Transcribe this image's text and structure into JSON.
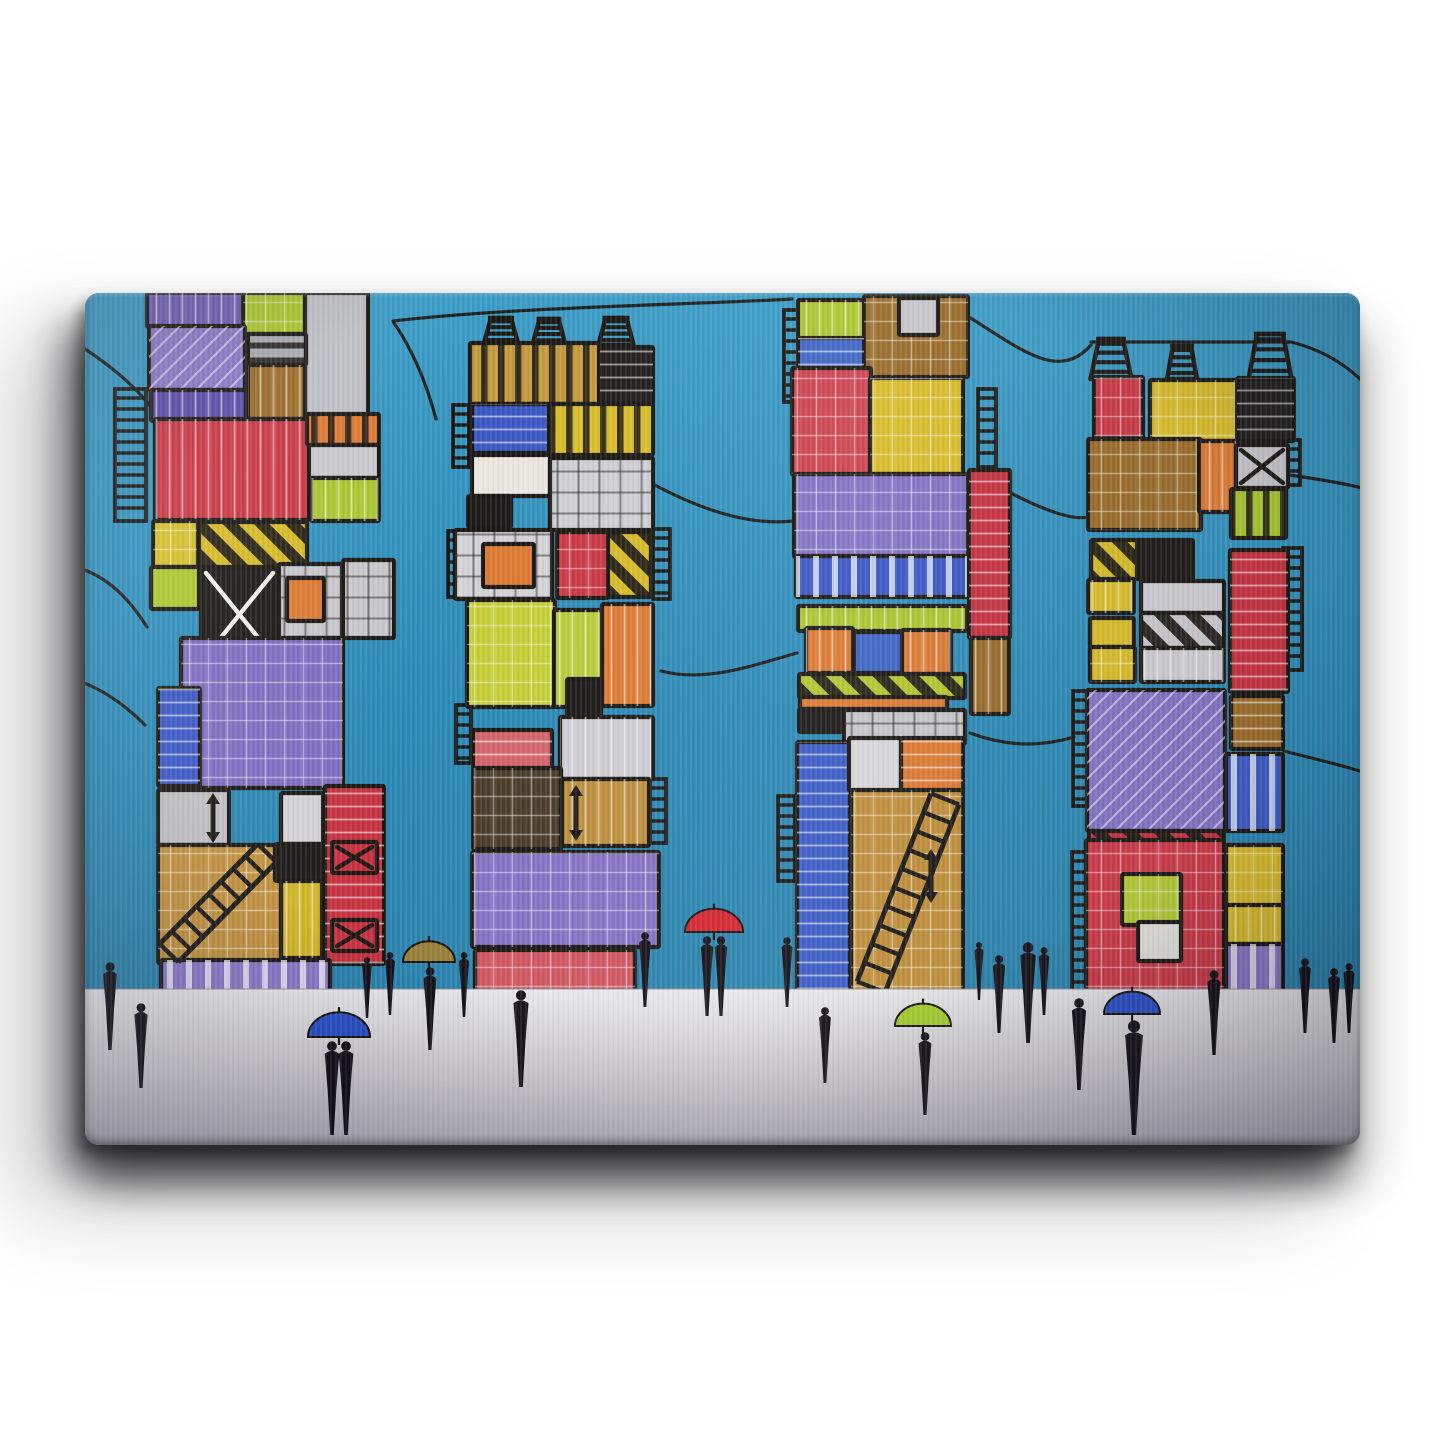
{
  "artwork": {
    "viewbox": "0 0 1275 852",
    "colors": {
      "sky": "#2b89b6",
      "sky_top": "#3b9cc6",
      "sky_bottom": "#2a7fa8",
      "ground_top": "#e8e7ea",
      "ground_mid": "#d2d0d5",
      "ground_bottom": "#b9b7be",
      "line": "#1b1814",
      "figure": "#15121a"
    },
    "ground_y": 696,
    "power_lines": [
      "M -6,52 C 55,92 88,128 102,196",
      "M -6,275 C 28,286 48,312 62,334",
      "M -6,388 C 22,398 44,416 60,432",
      "M 308,28 C 430,14 600,12 707,6",
      "M 309,30 C 331,62 343,96 351,126",
      "M 566,190 C 625,222 672,232 708,228",
      "M 576,378 C 622,390 668,372 712,360",
      "M 884,24 C 938,58 974,88 1006,52",
      "M 1006,49 L 1206,49",
      "M 1206,49 C 1242,58 1266,76 1281,92",
      "M 887,178 C 948,215 986,228 1003,224",
      "M 1204,182 C 1240,187 1266,192 1281,196",
      "M 885,440 C 928,456 962,452 989,444",
      "M 1199,458 C 1238,468 1264,474 1281,480"
    ],
    "towers": [
      {
        "name": "tower-1",
        "containers": [
          [
            62,
            0,
            96,
            34,
            "#6e5eb4",
            "vw"
          ],
          [
            158,
            0,
            62,
            41,
            "#aac72f",
            "gw"
          ],
          [
            220,
            0,
            63,
            126,
            "#bfc0c5",
            ""
          ],
          [
            64,
            33,
            96,
            64,
            "#8a7ac8",
            "dg"
          ],
          [
            66,
            97,
            95,
            31,
            "#5a4aa8",
            "vw"
          ],
          [
            163,
            41,
            58,
            31,
            "#a9aab0",
            "bh"
          ],
          [
            163,
            72,
            57,
            54,
            "#9a6b28",
            "vw"
          ],
          [
            70,
            126,
            154,
            101,
            "#c93744",
            "vw"
          ],
          [
            222,
            121,
            72,
            31,
            "#dd7a32",
            "bv"
          ],
          [
            224,
            152,
            70,
            33,
            "#c9c9ce",
            ""
          ],
          [
            226,
            185,
            68,
            43,
            "#aac72f",
            "vw"
          ],
          [
            68,
            228,
            45,
            46,
            "#d3c02b",
            "gw"
          ],
          [
            114,
            229,
            108,
            45,
            "#d6bb28",
            "hz"
          ],
          [
            66,
            274,
            48,
            42,
            "#aac72f",
            ""
          ],
          [
            116,
            275,
            77,
            93,
            "#1d1b1a",
            "xw"
          ],
          [
            194,
            271,
            63,
            74,
            "#c7c7cc",
            "gd"
          ],
          [
            202,
            285,
            37,
            43,
            "#dd7a32",
            ""
          ],
          [
            258,
            267,
            51,
            78,
            "#c7c7cc",
            "gd"
          ],
          [
            96,
            345,
            162,
            150,
            "#7e6cc0",
            "gw"
          ],
          [
            73,
            395,
            42,
            98,
            "#3a57c4",
            "hw"
          ],
          [
            73,
            497,
            71,
            55,
            "#bebec3",
            ""
          ],
          [
            73,
            552,
            171,
            118,
            "#c1903e",
            "gw"
          ],
          [
            196,
            500,
            42,
            51,
            "#d2d2d6",
            ""
          ],
          [
            190,
            551,
            48,
            37,
            "#1d1b1a",
            ""
          ],
          [
            196,
            588,
            41,
            77,
            "#d1b524",
            "vw"
          ],
          [
            240,
            493,
            59,
            178,
            "#c63140",
            "hw"
          ],
          [
            247,
            549,
            45,
            31,
            "#c63140",
            "xb"
          ],
          [
            247,
            627,
            45,
            31,
            "#c63140",
            "xb"
          ],
          [
            76,
            667,
            169,
            45,
            "#8a79c8",
            "wb"
          ]
        ],
        "racks": [
          [
            30,
            96,
            31,
            132
          ]
        ],
        "funnels": [],
        "stairs": [
          {
            "x1": 84,
            "y1": 660,
            "x2": 182,
            "y2": 560,
            "w": 26,
            "steps": 8
          }
        ],
        "arrows": [
          [
            128,
            500,
            550
          ]
        ]
      },
      {
        "name": "tower-2",
        "containers": [
          [
            385,
            50,
            129,
            61,
            "#c49a3e",
            "bv"
          ],
          [
            515,
            54,
            53,
            57,
            "#211f1e",
            "hw"
          ],
          [
            387,
            111,
            77,
            49,
            "#3a57c4",
            "hw"
          ],
          [
            464,
            111,
            104,
            51,
            "#d9bd2a",
            "bv"
          ],
          [
            387,
            162,
            78,
            41,
            "#e9e7e0",
            ""
          ],
          [
            383,
            203,
            43,
            31,
            "#1d1b1a",
            ""
          ],
          [
            465,
            165,
            103,
            72,
            "#cfcfd4",
            "gd"
          ],
          [
            370,
            237,
            97,
            69,
            "#d4d4d8",
            "gd"
          ],
          [
            398,
            251,
            51,
            43,
            "#dd7a32",
            ""
          ],
          [
            472,
            239,
            51,
            66,
            "#c93744",
            "gw"
          ],
          [
            523,
            239,
            43,
            65,
            "#d6bb28",
            "hz"
          ],
          [
            382,
            307,
            88,
            107,
            "#c6ce35",
            "gw"
          ],
          [
            469,
            317,
            48,
            97,
            "#b9cc3a",
            "vw"
          ],
          [
            517,
            311,
            51,
            102,
            "#dd7a32",
            "vw"
          ],
          [
            482,
            386,
            34,
            40,
            "#1d1b1a",
            ""
          ],
          [
            388,
            437,
            79,
            39,
            "#d4636b",
            "hw"
          ],
          [
            475,
            424,
            93,
            62,
            "#cdcdd2",
            "vw"
          ],
          [
            388,
            475,
            88,
            81,
            "#4a3b28",
            "gw"
          ],
          [
            477,
            486,
            87,
            67,
            "#bd8e3c",
            "vw"
          ],
          [
            387,
            559,
            187,
            95,
            "#8272c4",
            "gw"
          ],
          [
            390,
            657,
            160,
            41,
            "#cf5560",
            "gw"
          ]
        ],
        "racks": [
          [
            368,
            112,
            16,
            62
          ],
          [
            363,
            238,
            16,
            66
          ],
          [
            568,
            236,
            17,
            70
          ],
          [
            371,
            412,
            15,
            58
          ],
          [
            565,
            486,
            16,
            64
          ]
        ],
        "funnels": [
          [
            416,
            52,
            35,
            20,
            27
          ],
          [
            464,
            52,
            33,
            19,
            26
          ],
          [
            531,
            52,
            35,
            21,
            27
          ]
        ],
        "stairs": [],
        "arrows": [
          [
            491,
            492,
            548
          ]
        ]
      },
      {
        "name": "tower-3",
        "containers": [
          [
            713,
            7,
            67,
            39,
            "#aac72f",
            "vw"
          ],
          [
            779,
            3,
            104,
            81,
            "#9a6b28",
            "gw"
          ],
          [
            814,
            5,
            39,
            37,
            "#c7c7cc",
            ""
          ],
          [
            713,
            45,
            66,
            31,
            "#3f66c6",
            "hw"
          ],
          [
            707,
            75,
            79,
            107,
            "#cc4450",
            "gw"
          ],
          [
            785,
            85,
            93,
            96,
            "#d9bd2a",
            "gw"
          ],
          [
            709,
            181,
            174,
            83,
            "#8272c4",
            "gw"
          ],
          [
            711,
            263,
            173,
            41,
            "#3a57c4",
            "wb"
          ],
          [
            713,
            313,
            169,
            25,
            "#aac72f",
            "vw"
          ],
          [
            721,
            335,
            47,
            45,
            "#dd7a32",
            "vw"
          ],
          [
            769,
            339,
            49,
            41,
            "#3f66c6",
            ""
          ],
          [
            817,
            337,
            49,
            44,
            "#dd7a32",
            "vw"
          ],
          [
            714,
            381,
            166,
            24,
            "#b5c62f",
            "hz"
          ],
          [
            715,
            404,
            147,
            12,
            "#dd7a32",
            ""
          ],
          [
            714,
            416,
            45,
            23,
            "#1d1b1a",
            ""
          ],
          [
            759,
            417,
            121,
            34,
            "#c7c7cc",
            "gd"
          ],
          [
            712,
            449,
            53,
            251,
            "#3a5cc6",
            "hw"
          ],
          [
            764,
            445,
            52,
            53,
            "#d8d8db",
            ""
          ],
          [
            816,
            445,
            62,
            53,
            "#dd7a32",
            "hw"
          ],
          [
            766,
            497,
            112,
            203,
            "#bf8e3a",
            "gw"
          ],
          [
            884,
            177,
            41,
            168,
            "#c63140",
            "hw"
          ],
          [
            886,
            345,
            38,
            76,
            "#9a6b28",
            "vw"
          ]
        ],
        "racks": [
          [
            699,
            17,
            15,
            92
          ],
          [
            893,
            96,
            18,
            78
          ],
          [
            693,
            503,
            17,
            85
          ]
        ],
        "funnels": [],
        "stairs": [
          {
            "x1": 786,
            "y1": 694,
            "x2": 860,
            "y2": 506,
            "w": 30,
            "steps": 10
          }
        ],
        "arrows": [
          [
            846,
            556,
            610
          ]
        ]
      },
      {
        "name": "tower-4",
        "containers": [
          [
            1009,
            84,
            49,
            61,
            "#c93744",
            "gw"
          ],
          [
            1065,
            87,
            87,
            61,
            "#d9bd2a",
            "gw"
          ],
          [
            1152,
            85,
            57,
            63,
            "#211f1e",
            "hw"
          ],
          [
            1003,
            146,
            113,
            91,
            "#9a6b28",
            "gw"
          ],
          [
            1114,
            148,
            37,
            71,
            "#dd7a32",
            "vw"
          ],
          [
            1151,
            152,
            52,
            43,
            "#c7c7cc",
            "xb"
          ],
          [
            1146,
            196,
            55,
            49,
            "#aac72f",
            "bv"
          ],
          [
            1006,
            247,
            47,
            39,
            "#d6bb28",
            "hz"
          ],
          [
            1052,
            247,
            56,
            39,
            "#1d1b1a",
            ""
          ],
          [
            1145,
            257,
            58,
            142,
            "#c63140",
            "hw"
          ],
          [
            1003,
            287,
            46,
            33,
            "#d9bd2a",
            "vw"
          ],
          [
            1056,
            288,
            83,
            32,
            "#cdcdd2",
            ""
          ],
          [
            1056,
            320,
            83,
            35,
            "#c9c9cd",
            "hz"
          ],
          [
            1005,
            325,
            44,
            29,
            "#d9bd2a",
            ""
          ],
          [
            1005,
            354,
            45,
            35,
            "#d9bd2a",
            "gw"
          ],
          [
            1056,
            355,
            83,
            34,
            "#cdcdd2",
            "vw"
          ],
          [
            1002,
            397,
            138,
            141,
            "#8272c4",
            "dg"
          ],
          [
            1146,
            403,
            52,
            53,
            "#9a6b28",
            "hw"
          ],
          [
            1141,
            461,
            57,
            77,
            "#3a5cc6",
            "wb"
          ],
          [
            1004,
            538,
            135,
            11,
            "#c63140",
            "hz"
          ],
          [
            1001,
            547,
            138,
            157,
            "#cc3947",
            "gw"
          ],
          [
            1037,
            581,
            59,
            51,
            "#b5cc35",
            "gw"
          ],
          [
            1053,
            629,
            43,
            39,
            "#e6e4de",
            ""
          ],
          [
            1141,
            552,
            57,
            61,
            "#d9bd2a",
            "gw"
          ],
          [
            1141,
            612,
            57,
            39,
            "#d9bd2a",
            "vw"
          ],
          [
            1141,
            651,
            57,
            53,
            "#8a79c8",
            "wb"
          ]
        ],
        "racks": [
          [
            988,
            398,
            15,
            115
          ],
          [
            987,
            559,
            16,
            140
          ],
          [
            1198,
            147,
            17,
            45
          ],
          [
            1198,
            255,
            19,
            122
          ]
        ],
        "funnels": [
          [
            1026,
            86,
            41,
            24,
            40
          ],
          [
            1097,
            86,
            30,
            18,
            33
          ],
          [
            1185,
            86,
            43,
            26,
            45
          ]
        ],
        "stairs": [],
        "arrows": []
      }
    ],
    "people": [
      [
        25,
        669,
        757,
        "s"
      ],
      [
        56,
        710,
        795,
        "s"
      ],
      [
        254,
        748,
        842,
        "c"
      ],
      [
        282,
        664,
        725,
        "s"
      ],
      [
        305,
        659,
        722,
        "s"
      ],
      [
        345,
        674,
        757,
        "s"
      ],
      [
        379,
        659,
        724,
        "s"
      ],
      [
        436,
        697,
        794,
        "s"
      ],
      [
        560,
        639,
        714,
        "s"
      ],
      [
        629,
        643,
        723,
        "c"
      ],
      [
        702,
        644,
        714,
        "s"
      ],
      [
        740,
        714,
        790,
        "s"
      ],
      [
        840,
        739,
        822,
        "s"
      ],
      [
        894,
        649,
        707,
        "s"
      ],
      [
        914,
        662,
        740,
        "s"
      ],
      [
        943,
        649,
        750,
        "s"
      ],
      [
        959,
        654,
        722,
        "s"
      ],
      [
        994,
        705,
        797,
        "s"
      ],
      [
        1049,
        727,
        842,
        "s"
      ],
      [
        1129,
        677,
        762,
        "s"
      ],
      [
        1220,
        665,
        740,
        "s"
      ],
      [
        1249,
        675,
        750,
        "s"
      ],
      [
        1264,
        670,
        740,
        "s"
      ]
    ],
    "umbrellas": [
      [
        254,
        744,
        31,
        "#2b50c8"
      ],
      [
        344,
        669,
        26,
        "#97803a"
      ],
      [
        629,
        639,
        29,
        "#d42430"
      ],
      [
        838,
        733,
        28,
        "#a6cf2e"
      ],
      [
        1047,
        721,
        28,
        "#2b50c8"
      ]
    ]
  }
}
